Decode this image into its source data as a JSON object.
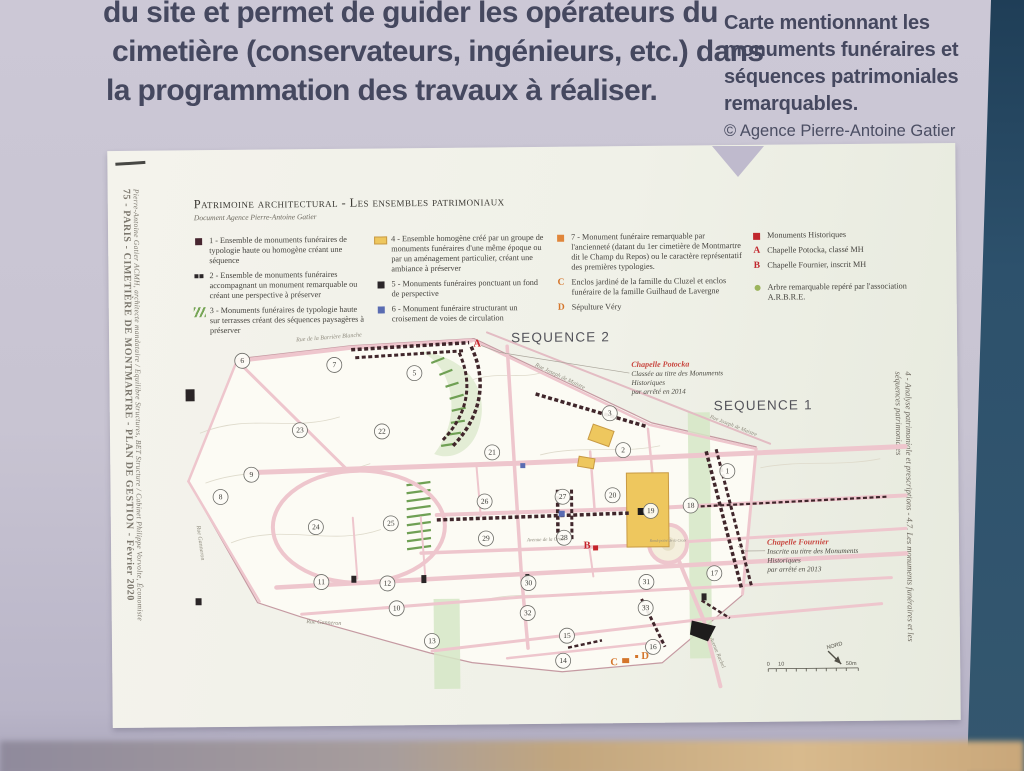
{
  "wall": {
    "paragraph_lines": [
      "du site et permet de guider les opérateurs du",
      "cimetière (conservateurs, ingénieurs, etc.) dans",
      "la programmation des travaux à réaliser."
    ],
    "caption_lines": [
      "Carte mentionnant les",
      "monuments funéraires et",
      "séquences patrimoniales",
      "remarquables."
    ],
    "credit": "© Agence Pierre-Antoine Gatier"
  },
  "poster": {
    "side_left_title": "75 - PARIS - CIMETIÈRE DE MONTMARTRE - PLAN DE GESTION - Février 2020",
    "side_left_sub": "Pierre-Antoine Gatier ACMH, architecte mandataire / Equilibre Structures, BET Structure / Cabinet Philippe Vorvolte, Économiste",
    "side_right": "4 - Analyse patrimoniale et prescriptions - 4.7. Les monuments funéraires et les séquences patrimoniales",
    "title": "Patrimoine architectural - Les ensembles patrimoniaux",
    "subtitle": "Document Agence Pierre-Antoine Gatier",
    "legend": {
      "columns": [
        {
          "items": [
            {
              "icon": "square",
              "color": "#472630",
              "text": "1 - Ensemble de monuments funéraires de typologie haute ou homogène créant une séquence"
            },
            {
              "icon": "dsquares",
              "color": "#2b2629",
              "text": "2 - Ensemble de monuments funéraires accompagnant un monument remarquable ou créant une perspective à préserver"
            },
            {
              "icon": "hatch",
              "color": "#76a556",
              "text": "3 - Monuments funéraires de typologie haute sur terrasses créant des séquences paysagères à préserver"
            }
          ]
        },
        {
          "items": [
            {
              "icon": "rect",
              "color": "#eec75e",
              "text": "4 - Ensemble homogène créé par un groupe de monuments funéraires d'une même époque ou par un aménagement particulier, créant une ambiance à préserver"
            },
            {
              "icon": "square",
              "color": "#2b2629",
              "text": "5 - Monuments funéraires ponctuant un fond de perspective"
            },
            {
              "icon": "square",
              "color": "#5a6cb2",
              "text": "6 - Monument funéraire structurant un croisement de voies de circulation"
            }
          ]
        },
        {
          "items": [
            {
              "icon": "square",
              "color": "#e0863b",
              "text": "7 - Monument funéraire remarquable par l'ancienneté (datant du 1er cimetière de Montmartre dit le Champ du Repos) ou le caractère représentatif des premières typologies."
            },
            {
              "icon": "letter",
              "letter": "C",
              "color": "#d4752b",
              "text": "Enclos jardiné de la famille du Cluzel et enclos funéraire de la famille Guilhaud de Lavergne"
            },
            {
              "icon": "letter",
              "letter": "D",
              "color": "#d4752b",
              "text": "Sépulture Véry"
            }
          ]
        },
        {
          "items": [
            {
              "icon": "square",
              "color": "#c1272d",
              "text": "Monuments Historiques"
            },
            {
              "icon": "letter",
              "letter": "A",
              "color": "#c1272d",
              "text": "Chapelle Potocka, classé MH"
            },
            {
              "icon": "letter",
              "letter": "B",
              "color": "#c1272d",
              "text": "Chapelle Fournier, inscrit MH"
            },
            {
              "icon": "dot",
              "color": "#9cb45c",
              "text": "Arbre remarquable repéré par l'association A.R.B.R.E."
            }
          ]
        }
      ]
    }
  },
  "map": {
    "bg": {
      "outline": "238,356 352,344 475,338 652,424 756,449 741,597 723,612 660,664 560,672 470,662 428,652 300,615 256,600 188,478"
    },
    "contours": [
      "M200,430 C250,410 290,430 340,415",
      "M205,480 C260,460 320,480 370,462",
      "M230,540 C280,520 330,545 380,528",
      "M470,380 C500,370 520,380 545,372",
      "M540,455 C580,445 620,455 660,447",
      "M760,470 C800,462 840,470 880,462",
      "M480,600 C520,590 560,600 600,592"
    ],
    "green_bands": [
      {
        "x": 688,
        "y": 414,
        "w": 22,
        "h": 246
      },
      {
        "x": 432,
        "y": 598,
        "w": 26,
        "h": 90
      }
    ],
    "terrace": "M420,350 C470,356 492,392 478,430 C470,452 450,460 434,453 C452,430 458,400 444,372 C436,358 426,352 420,350 Z",
    "green_hatch": [
      "432,362 445,357",
      "440,374 453,369",
      "446,386 459,382",
      "450,398 464,394",
      "452,410 466,407",
      "451,422 465,420",
      "447,434 461,432",
      "441,445 455,443",
      "406,484 430,481",
      "406,492 430,489",
      "406,500 430,497",
      "406,508 430,505",
      "406,516 430,513",
      "406,524 430,521",
      "406,532 430,529",
      "406,540 430,537",
      "406,548 430,545"
    ],
    "roads": [
      {
        "p": "240,358 352,346 472,340",
        "w": 4
      },
      {
        "p": "475,340 650,426 756,451",
        "w": 2.5
      },
      {
        "p": "488,332 770,446",
        "w": 2,
        "c": "#e3bcc3"
      },
      {
        "p": "246,470 520,463 905,450",
        "w": 5
      },
      {
        "p": "436,514 660,509 905,499",
        "w": 4
      },
      {
        "p": "420,552 646,546",
        "w": 3.5
      },
      {
        "p": "688,543 905,532",
        "w": 3
      },
      {
        "p": "275,585 520,574 905,557",
        "w": 4.5
      },
      {
        "p": "300,612 520,597 890,581",
        "w": 3
      },
      {
        "p": "430,650 700,621 880,607",
        "w": 3
      },
      {
        "p": "505,658 660,643",
        "w": 2.5
      },
      {
        "p": "508,346 514,463 520,574 526,648",
        "w": 3.5
      },
      {
        "p": "240,360 345,466",
        "w": 3
      },
      {
        "p": "188,478 238,357",
        "w": 2.5
      },
      {
        "p": "188,478 258,599",
        "w": 2.5
      },
      {
        "p": "590,452 594,512",
        "w": 2.5
      },
      {
        "p": "648,430 652,474",
        "w": 2.5
      },
      {
        "p": "756,451 741,596",
        "w": 3
      },
      {
        "p": "676,558 702,622 718,688",
        "w": 4
      },
      {
        "p": "352,516 356,577",
        "w": 2
      },
      {
        "p": "420,516 424,577",
        "w": 2
      },
      {
        "p": "476,463 480,516",
        "w": 2
      },
      {
        "p": "588,546 592,577",
        "w": 2
      }
    ],
    "oval": {
      "cx": 358,
      "cy": 525,
      "rx": 86,
      "ry": 56,
      "w": 4
    },
    "roundabout": {
      "cx": 667,
      "cy": 545,
      "r": 19
    },
    "yellows": [
      {
        "x": 626,
        "y": 474,
        "w": 42,
        "h": 74,
        "r": 0
      },
      {
        "x": 590,
        "y": 428,
        "w": 22,
        "h": 16,
        "r": 20
      },
      {
        "x": 578,
        "y": 458,
        "w": 16,
        "h": 10,
        "r": 10
      }
    ],
    "monuments": [
      {
        "d": "M352,348 L470,342",
        "w": 3.5
      },
      {
        "d": "M356,356 L466,350",
        "w": 3
      },
      {
        "d": "M472,346 C488,380 482,416 452,446",
        "w": 3.5
      },
      {
        "d": "M460,352 C474,384 468,414 442,440",
        "w": 3
      },
      {
        "d": "M536,394 L648,428",
        "w": 3.5
      },
      {
        "d": "M706,453 L740,590",
        "w": 3.5
      },
      {
        "d": "M716,451 L750,588",
        "w": 3
      },
      {
        "d": "M436,519 L628,514",
        "w": 3.5
      },
      {
        "d": "M557,490 L557,541",
        "w": 3.5
      },
      {
        "d": "M571,490 L571,541",
        "w": 3
      },
      {
        "d": "M700,508 L888,500",
        "w": 2.2
      },
      {
        "d": "M640,600 L663,648",
        "w": 3
      },
      {
        "d": "M700,602 L728,620",
        "w": 2.5
      },
      {
        "d": "M566,648 L600,641",
        "w": 2.5
      }
    ],
    "blobs": [
      {
        "pts": "690,622 714,628 706,643 688,636",
        "c": "#1e1c1c"
      }
    ],
    "squares": [
      {
        "x": 186,
        "y": 386,
        "w": 9,
        "h": 12,
        "c": "#2a2526"
      },
      {
        "x": 194,
        "y": 595,
        "w": 6,
        "h": 7,
        "c": "#2a2526"
      },
      {
        "x": 350,
        "y": 574,
        "w": 5,
        "h": 7,
        "c": "#2a2526"
      },
      {
        "x": 420,
        "y": 574,
        "w": 5,
        "h": 8,
        "c": "#2a2526"
      },
      {
        "x": 700,
        "y": 595,
        "w": 5,
        "h": 7,
        "c": "#2a2526"
      },
      {
        "x": 524,
        "y": 574,
        "w": 4,
        "h": 6,
        "c": "#2a2526"
      },
      {
        "x": 637,
        "y": 509,
        "w": 7,
        "h": 7,
        "c": "#1e1c1c"
      },
      {
        "x": 558,
        "y": 511,
        "w": 6,
        "h": 6,
        "c": "#5a6cb2"
      },
      {
        "x": 520,
        "y": 463,
        "w": 5,
        "h": 5,
        "c": "#5a6cb2"
      }
    ],
    "divisions": [
      {
        "n": "6",
        "x": 243,
        "y": 358
      },
      {
        "n": "7",
        "x": 335,
        "y": 363
      },
      {
        "n": "5",
        "x": 415,
        "y": 372
      },
      {
        "n": "3",
        "x": 610,
        "y": 414
      },
      {
        "n": "23",
        "x": 300,
        "y": 428
      },
      {
        "n": "22",
        "x": 382,
        "y": 430
      },
      {
        "n": "2",
        "x": 623,
        "y": 451
      },
      {
        "n": "21",
        "x": 492,
        "y": 452
      },
      {
        "n": "9",
        "x": 251,
        "y": 472
      },
      {
        "n": "1",
        "x": 727,
        "y": 473
      },
      {
        "n": "8",
        "x": 220,
        "y": 494
      },
      {
        "n": "27",
        "x": 562,
        "y": 497
      },
      {
        "n": "26",
        "x": 484,
        "y": 501
      },
      {
        "n": "20",
        "x": 612,
        "y": 496
      },
      {
        "n": "18",
        "x": 690,
        "y": 507
      },
      {
        "n": "19",
        "x": 650,
        "y": 512
      },
      {
        "n": "25",
        "x": 390,
        "y": 522
      },
      {
        "n": "24",
        "x": 315,
        "y": 525
      },
      {
        "n": "28",
        "x": 563,
        "y": 538
      },
      {
        "n": "29",
        "x": 485,
        "y": 538
      },
      {
        "n": "17",
        "x": 713,
        "y": 575
      },
      {
        "n": "11",
        "x": 320,
        "y": 580
      },
      {
        "n": "12",
        "x": 386,
        "y": 582
      },
      {
        "n": "30",
        "x": 527,
        "y": 583
      },
      {
        "n": "31",
        "x": 645,
        "y": 583
      },
      {
        "n": "10",
        "x": 395,
        "y": 607
      },
      {
        "n": "32",
        "x": 526,
        "y": 613
      },
      {
        "n": "33",
        "x": 644,
        "y": 609
      },
      {
        "n": "15",
        "x": 565,
        "y": 636
      },
      {
        "n": "13",
        "x": 430,
        "y": 640
      },
      {
        "n": "16",
        "x": 651,
        "y": 648
      },
      {
        "n": "14",
        "x": 561,
        "y": 661
      }
    ],
    "markers": [
      {
        "t": "A",
        "x": 478,
        "y": 346,
        "c": "#c4232a"
      },
      {
        "t": "B",
        "x": 586,
        "y": 549,
        "c": "#c4232a"
      },
      {
        "t": "C",
        "x": 612,
        "y": 666,
        "c": "#d4752b"
      },
      {
        "t": "D",
        "x": 643,
        "y": 660,
        "c": "#d4752b"
      }
    ],
    "marker_squares": [
      {
        "x": 592,
        "y": 546,
        "w": 5,
        "h": 5,
        "c": "#c4232a"
      },
      {
        "x": 620,
        "y": 659,
        "w": 7,
        "h": 5,
        "c": "#d4752b"
      },
      {
        "x": 633,
        "y": 656,
        "w": 3,
        "h": 3,
        "c": "#d4752b"
      }
    ],
    "streets": [
      {
        "t": "Rue de la Barrière Blanche",
        "x": 330,
        "y": 337,
        "r": -4,
        "s": 6
      },
      {
        "t": "Rue Joseph de Maistre",
        "x": 560,
        "y": 378,
        "r": 26,
        "s": 6
      },
      {
        "t": "Rue Joseph de Maistre",
        "x": 733,
        "y": 429,
        "r": 22,
        "s": 5.5
      },
      {
        "t": "Rue Ganneron",
        "x": 198,
        "y": 540,
        "r": 83,
        "s": 6
      },
      {
        "t": "Rue Ganneron",
        "x": 322,
        "y": 622,
        "r": 4,
        "s": 6
      },
      {
        "t": "Avenue Rachel",
        "x": 714,
        "y": 655,
        "r": 68,
        "s": 5.5
      },
      {
        "t": "Avenue de la Croix",
        "x": 545,
        "y": 541,
        "r": -1,
        "s": 5
      },
      {
        "t": "Rond-point de la Croix",
        "x": 667,
        "y": 543,
        "r": 0,
        "s": 4
      }
    ],
    "sequences": [
      {
        "t": "SEQUENCE 2",
        "x": 512,
        "y": 342
      },
      {
        "t": "SEQUENCE 1",
        "x": 714,
        "y": 412
      }
    ],
    "annotations": [
      {
        "x": 632,
        "y": 368,
        "title": "Chapelle Potocka",
        "lines": [
          "Classée au titre des Monuments",
          "Historiques",
          "par arrêté en 2014"
        ],
        "leader": "630,374 500,352 482,345"
      },
      {
        "x": 766,
        "y": 547,
        "title": "Chapelle Fournier",
        "lines": [
          "Inscrite au titre des Monuments",
          "Historiques",
          "par arrêté en 2013"
        ],
        "leader": "764,553 744,553 737,548"
      }
    ],
    "north": {
      "t": "NORD",
      "x": 833,
      "y": 650
    },
    "scale": {
      "x1": 766,
      "x2": 856,
      "y": 671,
      "labels": [
        {
          "t": "0",
          "x": 766
        },
        {
          "t": "10",
          "x": 779
        },
        {
          "t": "50m",
          "x": 849
        }
      ]
    }
  }
}
